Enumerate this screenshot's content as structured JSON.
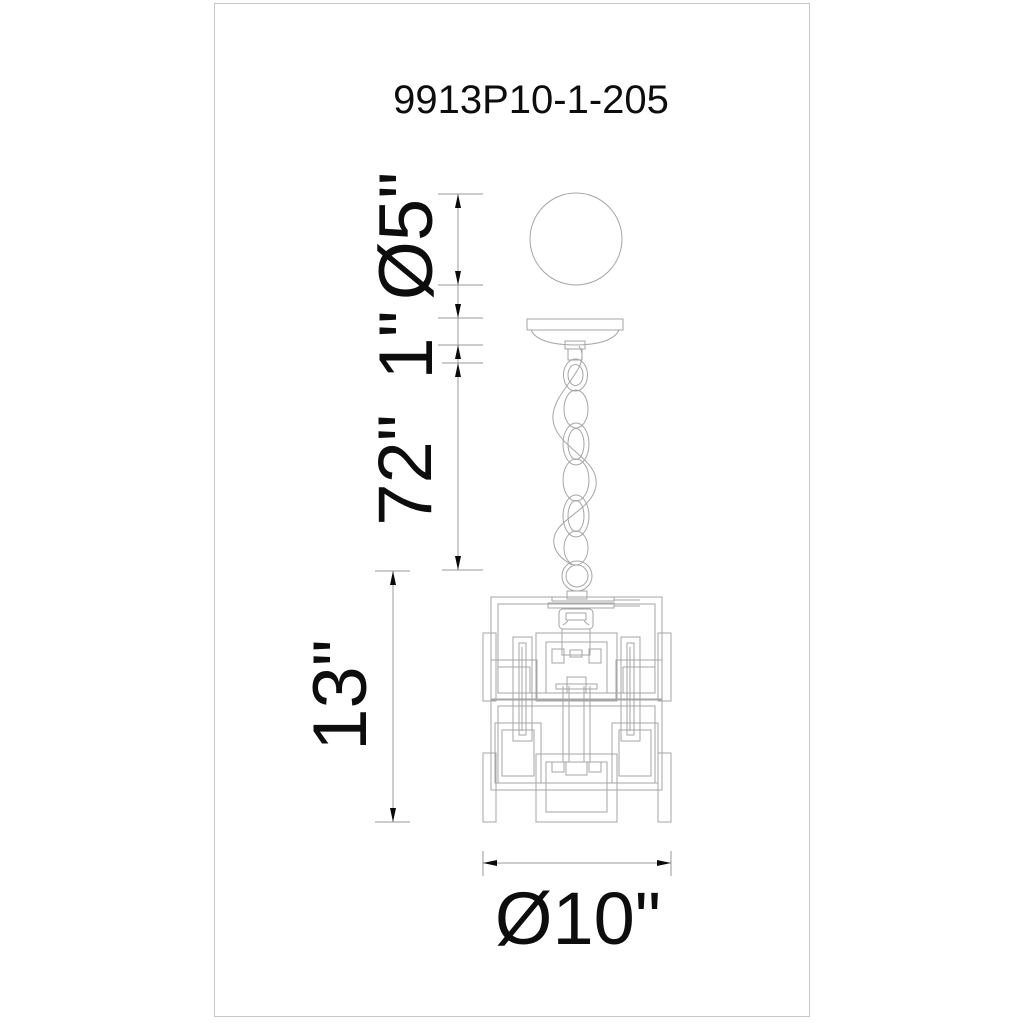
{
  "sheet": {
    "model_number": "9913P10-1-205",
    "type": "pendant-light-dimension-drawing"
  },
  "dimension_labels": {
    "ball_diameter": "Ø5\"",
    "canopy_height": "1\"",
    "chain_length": "72\"",
    "body_height": "13\"",
    "body_diameter": "Ø10\""
  },
  "drawing_elements": {
    "top": "sphere canopy ball",
    "middle": "ceiling canopy with chain and cord",
    "bottom": "rectilinear cage pendant body"
  },
  "colors": {
    "background": "#ffffff",
    "border": "#c6c6c6",
    "artwork_line": "#a6a6a6",
    "dimension_line": "#9a9a9a",
    "arrow": "#0a0a0a",
    "text": "#0d0d0d"
  }
}
